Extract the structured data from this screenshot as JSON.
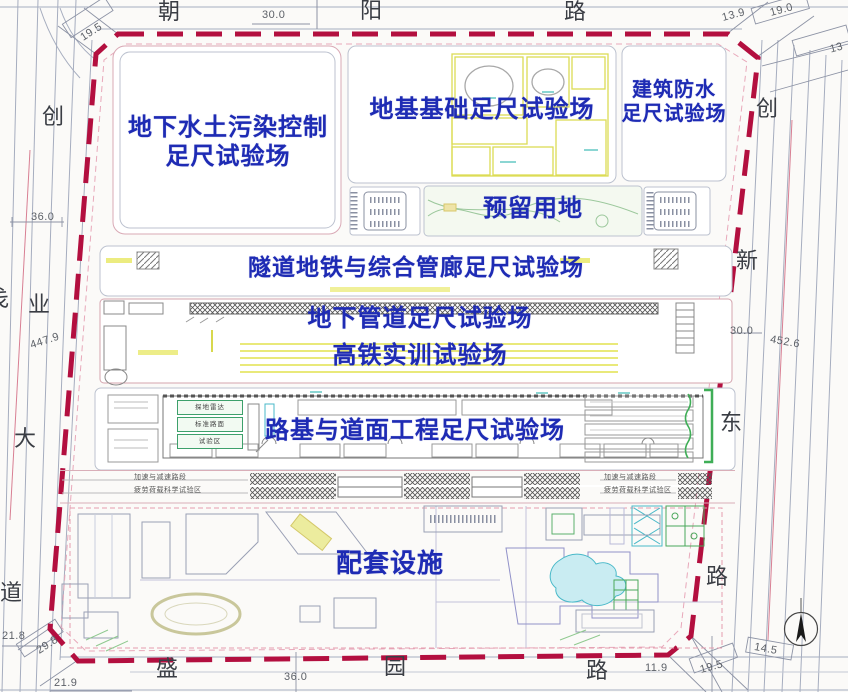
{
  "roads": {
    "top": {
      "c0": "朝",
      "c1": "阳",
      "c2": "路"
    },
    "bottom": {
      "c0": "盛",
      "c1": "园",
      "c2": "路"
    },
    "left": {
      "c0": "创",
      "c1": "业",
      "c2": "大",
      "c3": "道",
      "partial": "戋"
    },
    "right": {
      "c0": "创",
      "c1": "新",
      "c2": "东",
      "c3": "路"
    }
  },
  "dims": {
    "top_195": "19.5",
    "top_300": "30.0",
    "top_139": "13.9",
    "top_190": "19.0",
    "top_13": "13",
    "left_360": "36.0",
    "left_4479": "447.9",
    "left_218": "21.8",
    "left_298": "29.8",
    "left_219": "21.9",
    "right_300": "30.0",
    "right_4526": "452.6",
    "right_145": "14.5",
    "bottom_360": "36.0",
    "bottom_119": "11.9",
    "bottom_195": "19.5"
  },
  "zones": {
    "pollution": {
      "line1": "地下水土污染控制",
      "line2": "足尺试验场"
    },
    "foundation": {
      "label": "地基基础足尺试验场"
    },
    "waterproof": {
      "line1": "建筑防水",
      "line2": "足尺试验场"
    },
    "reserved": {
      "label": "预留用地"
    },
    "tunnel": {
      "label": "隧道地铁与综合管廊足尺试验场"
    },
    "pipeline": {
      "label": "地下管道足尺试验场"
    },
    "railway": {
      "label": "高铁实训试验场"
    },
    "roadbed": {
      "label": "路基与道面工程足尺试验场"
    },
    "support": {
      "label": "配套设施"
    }
  },
  "micro": {
    "accel": "加速与减速路段",
    "load": "疲劳荷载科学试验区",
    "radar": "探地雷达",
    "std_road": "标准路面",
    "test_area": "试验区"
  },
  "colors": {
    "boundary": "#b30f3f",
    "setback_pink": "#e8a8ba",
    "label_blue": "#1e2bb4",
    "cad_yellow": "#dede52",
    "cad_green": "#3fae57",
    "cad_teal": "#49b9c9",
    "road_line": "#a6adbf"
  }
}
